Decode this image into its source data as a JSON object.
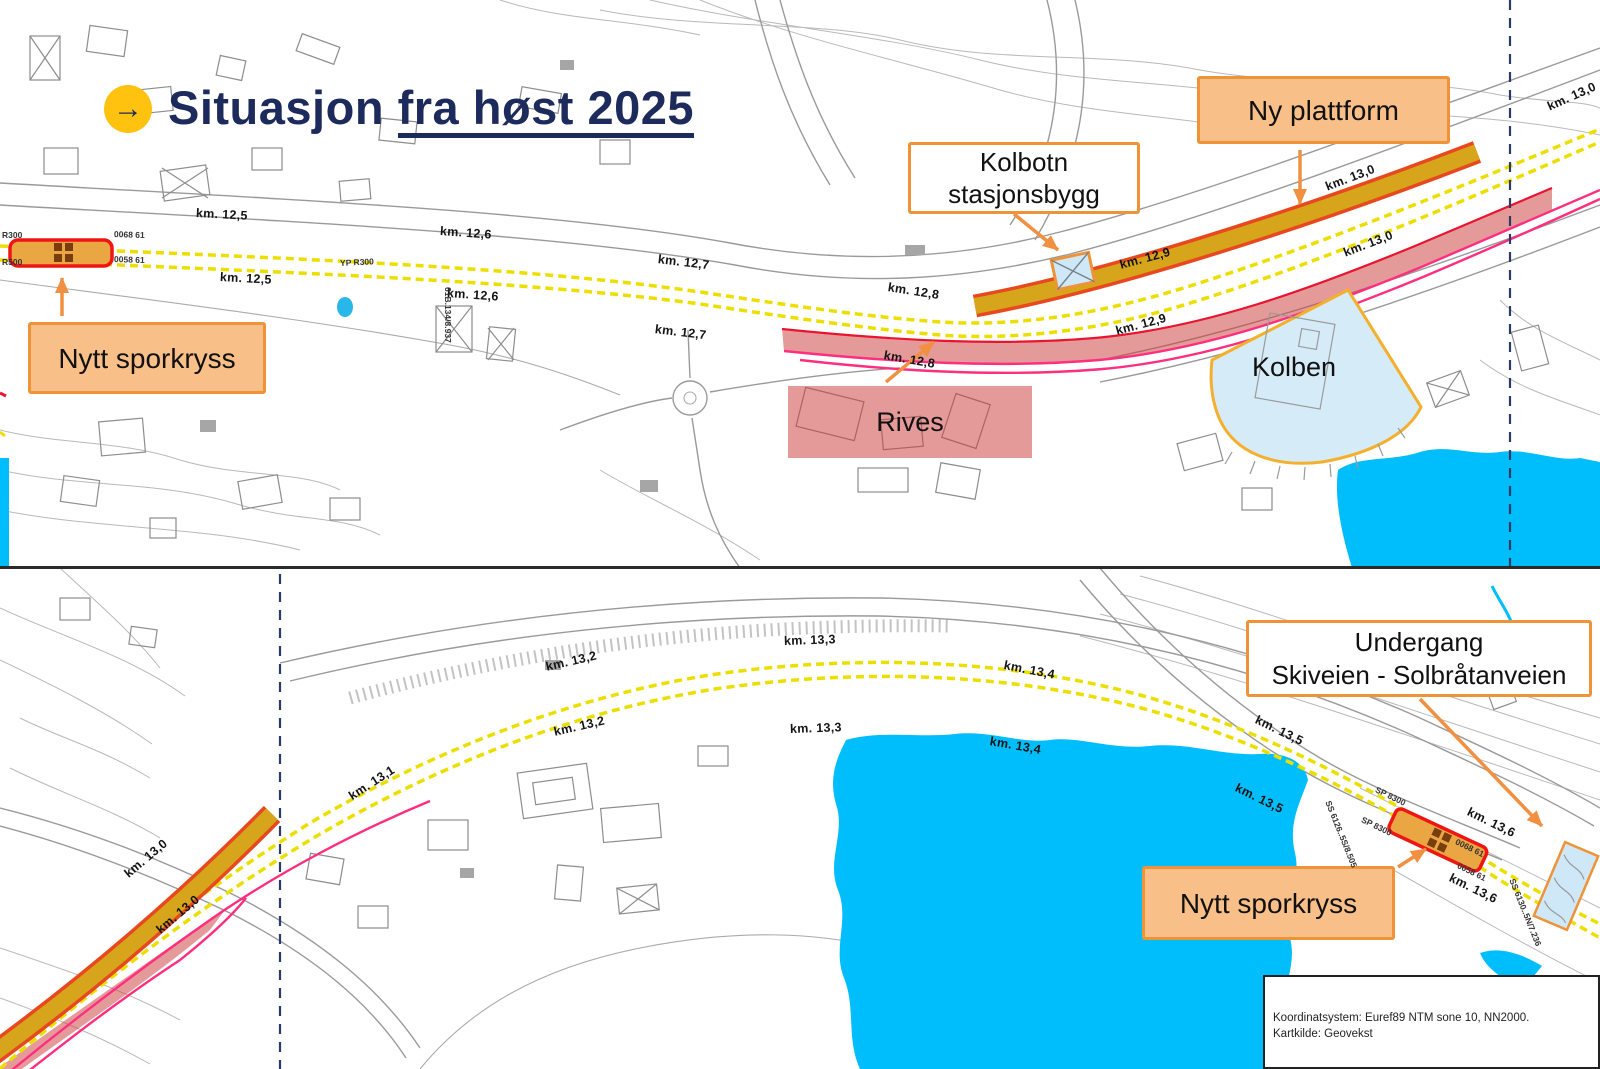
{
  "title": {
    "icon_glyph": "→",
    "prefix": "Situasjon ",
    "underlined": "fra høst 2025"
  },
  "callouts": {
    "ny_plattform": {
      "label": "Ny plattform"
    },
    "kolbotn_stasjonsbygg": {
      "line1": "Kolbotn",
      "line2": "stasjonsbygg"
    },
    "nytt_sporkryss_top": {
      "label": "Nytt sporkryss"
    },
    "rives": {
      "label": "Rives"
    },
    "kolben": {
      "label": "Kolben"
    },
    "undergang": {
      "line1": "Undergang",
      "line2": "Skiveien - Solbråtanveien"
    },
    "nytt_sporkryss_bottom": {
      "label": "Nytt sporkryss"
    }
  },
  "map_meta": {
    "coordinate_system": "Koordinatsystem: Euref89 NTM sone 10, NN2000.",
    "map_source": "Kartkilde: Geovekst"
  },
  "km_labels": [
    {
      "t": "km. 12,5",
      "x": 196,
      "y": 206,
      "r": 3
    },
    {
      "t": "km. 12,5",
      "x": 220,
      "y": 270,
      "r": 3
    },
    {
      "t": "km. 12,6",
      "x": 440,
      "y": 224,
      "r": 4
    },
    {
      "t": "km. 12,6",
      "x": 447,
      "y": 286,
      "r": 4
    },
    {
      "t": "km. 12,7",
      "x": 658,
      "y": 252,
      "r": 7
    },
    {
      "t": "km. 12,7",
      "x": 655,
      "y": 322,
      "r": 7
    },
    {
      "t": "km. 12,8",
      "x": 888,
      "y": 280,
      "r": 9
    },
    {
      "t": "km. 12,8",
      "x": 884,
      "y": 348,
      "r": 10
    },
    {
      "t": "km. 12,9",
      "x": 1120,
      "y": 258,
      "r": -15
    },
    {
      "t": "km. 12,9",
      "x": 1116,
      "y": 324,
      "r": -15
    },
    {
      "t": "km. 13,0",
      "x": 1326,
      "y": 180,
      "r": -21
    },
    {
      "t": "km. 13,0",
      "x": 1344,
      "y": 246,
      "r": -21
    },
    {
      "t": "km. 13,0",
      "x": 1548,
      "y": 100,
      "r": -24
    },
    {
      "t": "km. 13,0",
      "x": 126,
      "y": 868,
      "r": -40
    },
    {
      "t": "km. 13,0",
      "x": 158,
      "y": 924,
      "r": -40
    },
    {
      "t": "km. 13,1",
      "x": 350,
      "y": 790,
      "r": -33
    },
    {
      "t": "km. 13,2",
      "x": 546,
      "y": 660,
      "r": -13
    },
    {
      "t": "km. 13,2",
      "x": 554,
      "y": 725,
      "r": -13
    },
    {
      "t": "km. 13,3",
      "x": 784,
      "y": 634,
      "r": -2
    },
    {
      "t": "km. 13,3",
      "x": 790,
      "y": 722,
      "r": -2
    },
    {
      "t": "km. 13,4",
      "x": 1004,
      "y": 658,
      "r": 11
    },
    {
      "t": "km. 13,4",
      "x": 990,
      "y": 734,
      "r": 10
    },
    {
      "t": "km. 13,5",
      "x": 1256,
      "y": 712,
      "r": 26
    },
    {
      "t": "km. 13,5",
      "x": 1236,
      "y": 780,
      "r": 26
    },
    {
      "t": "km. 13,6",
      "x": 1468,
      "y": 804,
      "r": 26
    },
    {
      "t": "km. 13,6",
      "x": 1450,
      "y": 870,
      "r": 26
    }
  ],
  "track_codes": [
    {
      "t": "R300",
      "x": 2,
      "y": 230,
      "r": 0
    },
    {
      "t": "R500",
      "x": 2,
      "y": 257,
      "r": 0
    },
    {
      "t": "0068 61",
      "x": 114,
      "y": 229,
      "r": 2
    },
    {
      "t": "0058 61",
      "x": 114,
      "y": 254,
      "r": 2
    },
    {
      "t": "YP R300",
      "x": 340,
      "y": 258,
      "r": -3
    },
    {
      "t": "61B.134/8.937",
      "x": 448,
      "y": 282,
      "r": 90
    },
    {
      "t": "SP 8300",
      "x": 1376,
      "y": 784,
      "r": 26
    },
    {
      "t": "SP 8300",
      "x": 1362,
      "y": 814,
      "r": 26
    },
    {
      "t": "0068 61",
      "x": 1456,
      "y": 836,
      "r": 26
    },
    {
      "t": "0058 61",
      "x": 1458,
      "y": 860,
      "r": 26
    },
    {
      "t": "SS 6126..5S/8.505",
      "x": 1328,
      "y": 796,
      "r": 68
    },
    {
      "t": "SS 6130..5N/7.236",
      "x": 1512,
      "y": 874,
      "r": 68
    }
  ],
  "colors": {
    "navy": "#1c2a5c",
    "accent_yellow": "#ffc20e",
    "water": "#00bdfc",
    "track_yellow": "#ecdf00",
    "platform_fill": "#d7a51b",
    "platform_border": "#e8481e",
    "magenta_line": "#ff2e7e",
    "crimson_line": "#e81430",
    "demolish_overlay": "rgba(205,62,62,0.52)",
    "callout_fill": "#f8bf88",
    "callout_border": "#ee9338",
    "station_blue": "#cfe8f7",
    "kolben_fill": "#d6ebf8",
    "kolben_border": "#f4b02c",
    "arrow_orange": "#f09040",
    "dashed_border": "#2c3a66"
  }
}
